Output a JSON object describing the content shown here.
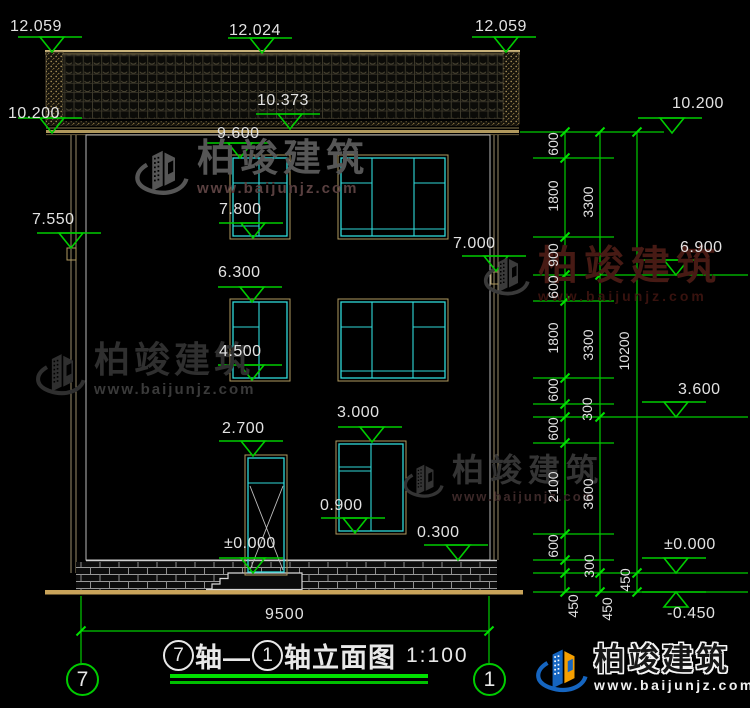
{
  "drawing_title": {
    "axis_from": "7",
    "joiner": "轴—",
    "axis_to": "1",
    "suffix": "轴立面图",
    "scale": "1:100"
  },
  "axis_bubbles": {
    "left": "7",
    "right": "1"
  },
  "dims": {
    "overall_width": "9500",
    "right_inner": [
      "600",
      "1800",
      "900",
      "600",
      "1800",
      "600",
      "300",
      "600",
      "2100",
      "600",
      "300",
      "450"
    ],
    "right_mid": [
      "3300",
      "3300",
      "3600",
      "450"
    ],
    "right_outer": [
      "10200",
      "450"
    ]
  },
  "elevations": {
    "roof_left": "12.059",
    "roof_ridge": "12.024",
    "roof_right": "12.059",
    "eave_left": "10.200",
    "fascia": "10.373",
    "eave_right": "10.200",
    "wall_top": "9.600",
    "beam_left": "7.550",
    "win3_bottom": "7.800",
    "canopy_right": "7.000",
    "floor3": "6.900",
    "win2_top": "6.300",
    "win2_bottom": "4.500",
    "floor2": "3.600",
    "win1_top": "3.000",
    "door_top": "2.700",
    "win1_bottom": "0.900",
    "plinth_top": "0.300",
    "ground_door": "±0.000",
    "ground_right": "±0.000",
    "below_ground": "-0.450"
  },
  "watermark": {
    "brand": "柏竣建筑",
    "site": "www.baijunjz.com"
  },
  "brand_footer": {
    "brand": "柏竣建筑",
    "site": "www.baijunjz.com"
  }
}
